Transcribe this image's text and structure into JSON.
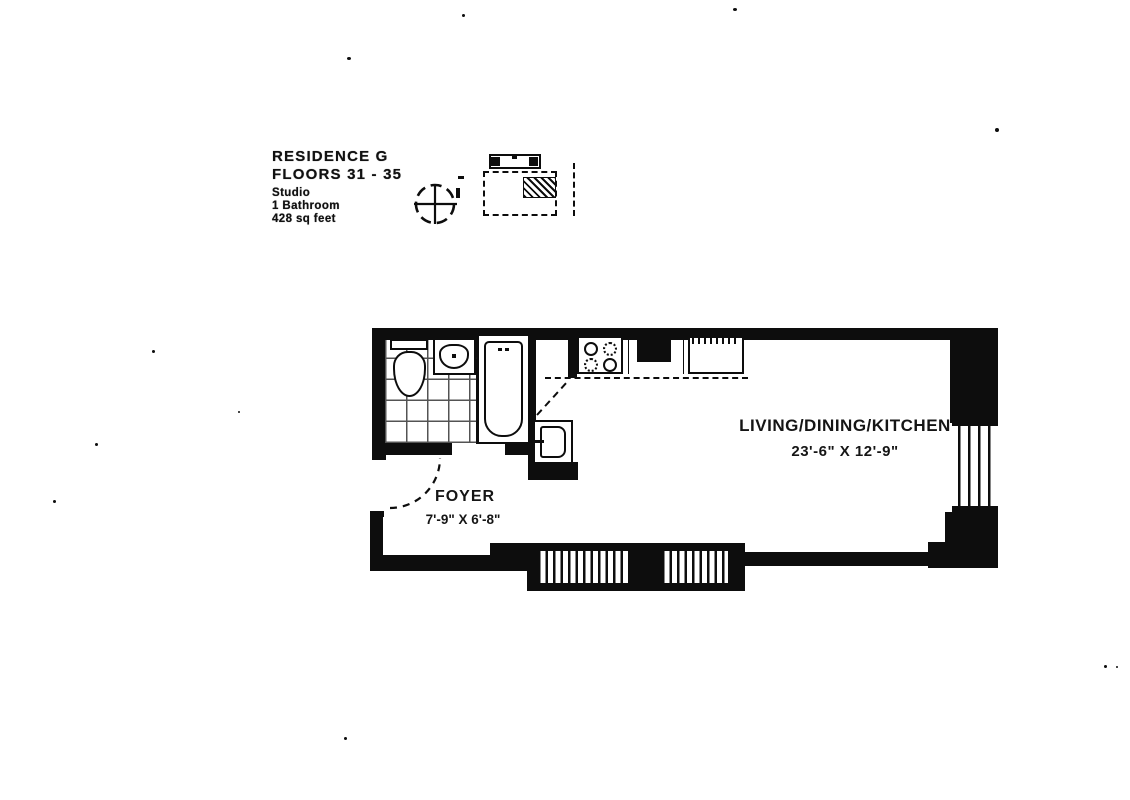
{
  "title_block": {
    "residence": "RESIDENCE G",
    "floors": "FLOORS 31 - 35",
    "unit_type": "Studio",
    "bathrooms": "1 Bathroom",
    "area": "428 sq feet"
  },
  "rooms": {
    "living_dining_kitchen": {
      "label": "LIVING/DINING/KITCHEN",
      "dimensions": "23'-6\" X 12'-9\""
    },
    "foyer": {
      "label": "FOYER",
      "dimensions": "7'-9\" X 6'-8\""
    }
  },
  "icons": {
    "compass": "north-compass-icon",
    "key_plan": "building-key-plan",
    "unit_marker": "unit-location-hatch"
  },
  "colors": {
    "ink": "#0d0d0d",
    "paper": "#ffffff"
  }
}
